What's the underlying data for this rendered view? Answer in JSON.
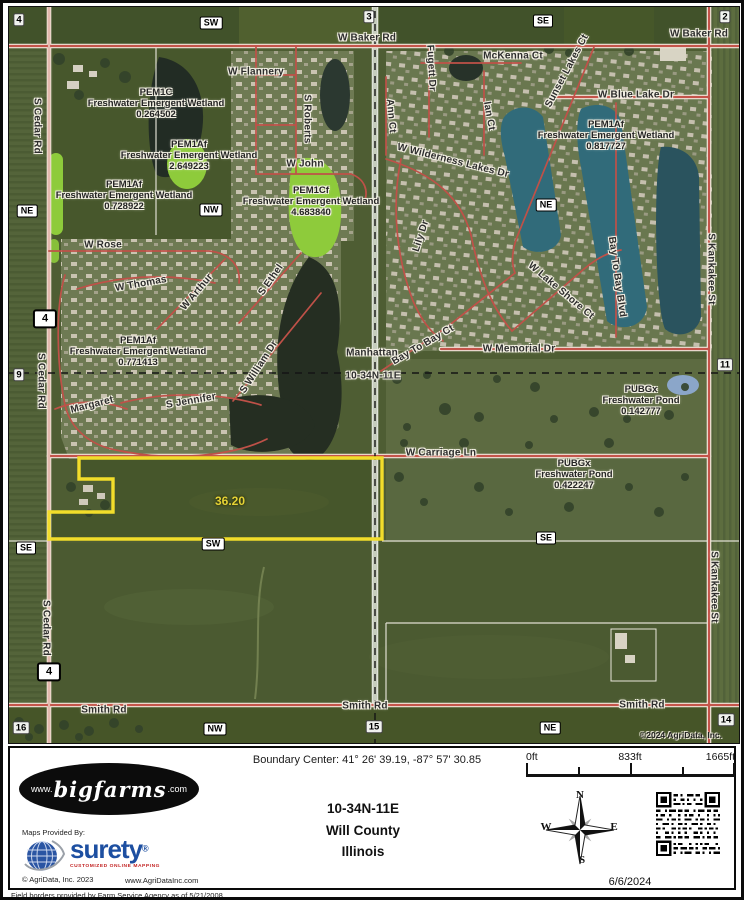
{
  "map": {
    "acreage_label": "36.20",
    "copyright": "©2024 AgriData, Inc.",
    "road_labels": [
      {
        "text": "W Baker Rd",
        "style": "left:358px;top:31px"
      },
      {
        "text": "W Baker Rd",
        "style": "left:690px;top:27px"
      },
      {
        "text": "W Flannery",
        "style": "left:247px;top:65px"
      },
      {
        "text": "S Roberts",
        "style": "left:298px;top:112px;transform:translate(-50%,-50%) rotate(90deg)"
      },
      {
        "text": "S Cedar Rd",
        "style": "left:28px;top:119px;transform:translate(-50%,-50%) rotate(90deg)"
      },
      {
        "text": "S Cedar Rd",
        "style": "left:32px;top:374px;transform:translate(-50%,-50%) rotate(90deg)"
      },
      {
        "text": "S Cedar Rd",
        "style": "left:37px;top:621px;transform:translate(-50%,-50%) rotate(90deg)"
      },
      {
        "text": "W John",
        "style": "left:296px;top:157px"
      },
      {
        "text": "W Rose",
        "style": "left:94px;top:238px"
      },
      {
        "text": "W Thomas",
        "style": "left:132px;top:277px;transform:translate(-50%,-50%) rotate(-10deg)"
      },
      {
        "text": "W Arthur",
        "style": "left:188px;top:285px;transform:translate(-50%,-50%) rotate(-50deg)"
      },
      {
        "text": "S Ethel",
        "style": "left:262px;top:273px;transform:translate(-50%,-50%) rotate(-55deg)"
      },
      {
        "text": "S William Dr",
        "style": "left:250px;top:360px;transform:translate(-50%,-50%) rotate(-57deg)"
      },
      {
        "text": "Margaret",
        "style": "left:83px;top:398px;transform:translate(-50%,-50%) rotate(-14deg)"
      },
      {
        "text": "S Jennifer",
        "style": "left:182px;top:394px;transform:translate(-50%,-50%) rotate(-10deg)"
      },
      {
        "text": "McKenna Ct",
        "style": "left:504px;top:49px"
      },
      {
        "text": "Fugett Dr",
        "style": "left:422px;top:61px;transform:translate(-50%,-50%) rotate(87deg)"
      },
      {
        "text": "Ann Ct",
        "style": "left:382px;top:109px;transform:translate(-50%,-50%) rotate(85deg)"
      },
      {
        "text": "Ian Ct",
        "style": "left:480px;top:109px;transform:translate(-50%,-50%) rotate(80deg)"
      },
      {
        "text": "Sunset Lakes Ct",
        "style": "left:558px;top:64px;transform:translate(-50%,-50%) rotate(-62deg)"
      },
      {
        "text": "W Blue Lake Dr",
        "style": "left:627px;top:88px"
      },
      {
        "text": "W Wilderness Lakes Dr",
        "style": "left:444px;top:154px;transform:translate(-50%,-50%) rotate(14deg)"
      },
      {
        "text": "Lily Dr",
        "style": "left:412px;top:229px;transform:translate(-50%,-50%) rotate(-72deg)"
      },
      {
        "text": "S Kankakee St",
        "style": "left:702px;top:262px;transform:translate(-50%,-50%) rotate(90deg)"
      },
      {
        "text": "S Kankakee St",
        "style": "left:705px;top:580px;transform:translate(-50%,-50%) rotate(90deg)"
      },
      {
        "text": "W Lake Shore Ct",
        "style": "left:552px;top:284px;transform:translate(-50%,-50%) rotate(40deg)"
      },
      {
        "text": "Bay To Bay Blvd",
        "style": "left:608px;top:270px;transform:translate(-50%,-50%) rotate(82deg)"
      },
      {
        "text": "Bay To Bay Ct",
        "style": "left:414px;top:338px;transform:translate(-50%,-50%) rotate(-30deg)"
      },
      {
        "text": "W Memorial Dr",
        "style": "left:510px;top:342px"
      },
      {
        "text": "W Carriage Ln",
        "style": "left:432px;top:446px"
      },
      {
        "text": "Smith Rd",
        "style": "left:95px;top:703px"
      },
      {
        "text": "Smith Rd",
        "style": "left:356px;top:699px"
      },
      {
        "text": "Smith Rd",
        "style": "left:633px;top:698px"
      },
      {
        "text": "Manhattan",
        "style": "left:363px;top:346px"
      },
      {
        "text": "10-34N-11E",
        "style": "left:364px;top:369px"
      }
    ],
    "wetland_labels": [
      {
        "code": "PEM1C",
        "name": "Freshwater Emergent Wetland",
        "acres": "0.264502",
        "style": "left:147px;top:97px"
      },
      {
        "code": "PEM1Af",
        "name": "Freshwater Emergent Wetland",
        "acres": "2.649223",
        "style": "left:180px;top:149px"
      },
      {
        "code": "PEM1Af",
        "name": "Freshwater Emergent Wetland",
        "acres": "0.728922",
        "style": "left:115px;top:189px"
      },
      {
        "code": "PEM1Cf",
        "name": "Freshwater Emergent Wetland",
        "acres": "4.683840",
        "style": "left:302px;top:195px"
      },
      {
        "code": "PEM1Af",
        "name": "Freshwater Emergent Wetland",
        "acres": "0.817727",
        "style": "left:597px;top:129px"
      },
      {
        "code": "PEM1Af",
        "name": "Freshwater Emergent Wetland",
        "acres": "0.771413",
        "style": "left:129px;top:345px"
      },
      {
        "code": "PUBGx",
        "name": "Freshwater Pond",
        "acres": "0.142777",
        "style": "left:632px;top:394px"
      },
      {
        "code": "PUBGx",
        "name": "Freshwater Pond",
        "acres": "0.422247",
        "style": "left:565px;top:468px"
      }
    ],
    "quadrant_badges": [
      {
        "text": "SW",
        "style": "left:202px;top:16px"
      },
      {
        "text": "SE",
        "style": "left:534px;top:14px"
      },
      {
        "text": "NE",
        "style": "left:18px;top:204px"
      },
      {
        "text": "NW",
        "style": "left:202px;top:203px"
      },
      {
        "text": "NE",
        "style": "left:537px;top:198px"
      },
      {
        "text": "SE",
        "style": "left:17px;top:541px"
      },
      {
        "text": "SW",
        "style": "left:204px;top:537px"
      },
      {
        "text": "SE",
        "style": "left:537px;top:531px"
      },
      {
        "text": "NW",
        "style": "left:206px;top:722px"
      },
      {
        "text": "NE",
        "style": "left:541px;top:721px"
      }
    ],
    "section_markers": [
      {
        "text": "4",
        "style": "left:10px;top:13px"
      },
      {
        "text": "3",
        "style": "left:360px;top:10px"
      },
      {
        "text": "2",
        "style": "left:716px;top:10px"
      },
      {
        "text": "9",
        "style": "left:10px;top:368px"
      },
      {
        "text": "11",
        "style": "left:716px;top:358px"
      },
      {
        "text": "16",
        "style": "left:12px;top:721px"
      },
      {
        "text": "15",
        "style": "left:365px;top:720px"
      },
      {
        "text": "14",
        "style": "left:717px;top:713px"
      }
    ],
    "highway_shields": [
      {
        "text": "4",
        "style": "left:36px;top:312px"
      },
      {
        "text": "4",
        "style": "left:40px;top:665px"
      }
    ]
  },
  "footer": {
    "boundary_center": "Boundary Center: 41° 26' 39.19,  -87° 57' 30.85",
    "township": "10-34N-11E",
    "county": "Will County",
    "state": "Illinois",
    "date": "6/6/2024",
    "scale": {
      "start": "0ft",
      "mid": "833ft",
      "end": "1665ft"
    },
    "compass": {
      "n": "N",
      "e": "E",
      "s": "S",
      "w": "W"
    },
    "bigfarms": {
      "prefix": "www.",
      "name": "bigfarms",
      "suffix": ".com"
    },
    "provider": {
      "heading": "Maps Provided By:",
      "name": "surety",
      "registered": "®",
      "tagline": "CUSTOMIZED ONLINE MAPPING",
      "copyright": "© AgriData, Inc. 2023",
      "website": "www.AgriDataInc.com"
    }
  },
  "disclaimer": "Field borders provided by Farm Service Agency as of 5/21/2008"
}
